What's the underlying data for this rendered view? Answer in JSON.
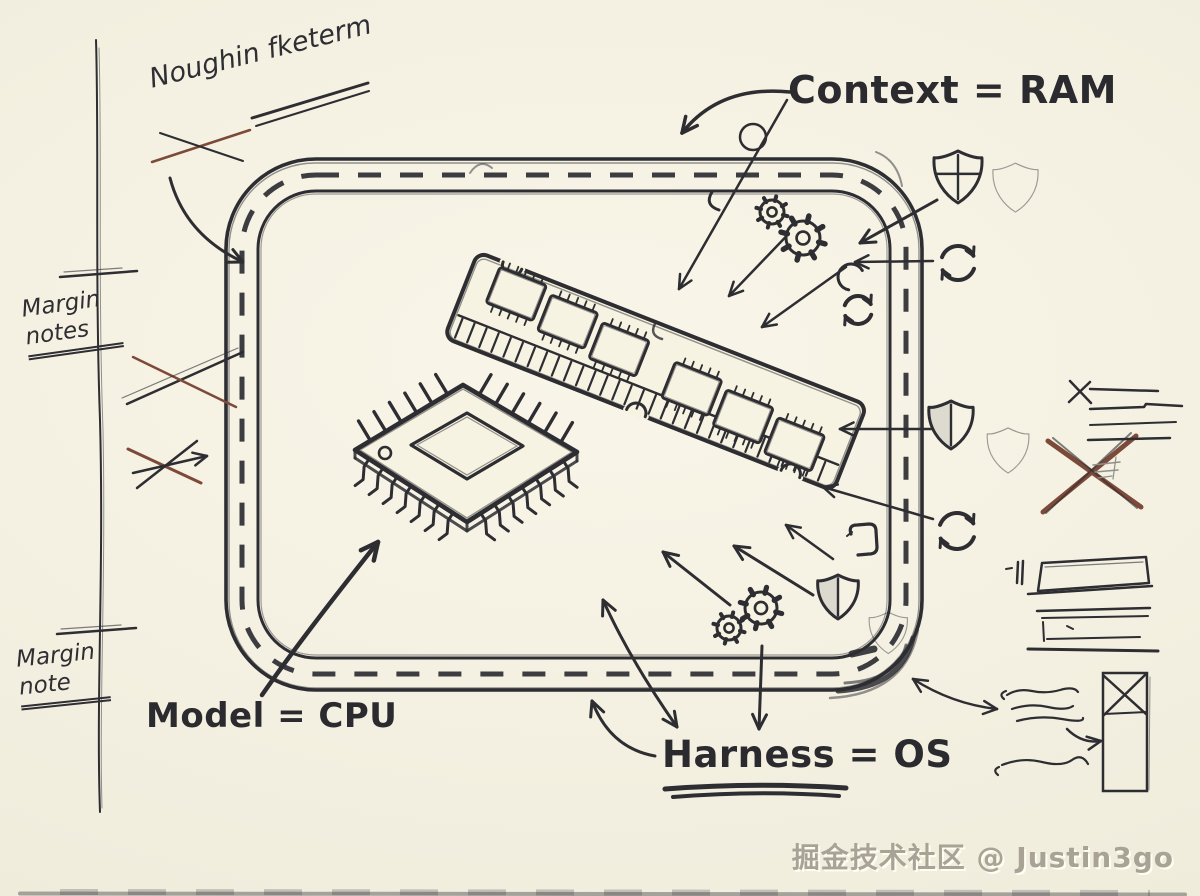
{
  "colors": {
    "paper": "#f7f3e2",
    "ink": "#2d2d32",
    "brown": "#7d4a39",
    "gray": "#90908a",
    "watermark_gray": "#a9a396"
  },
  "sketch": {
    "top_note": "Noughin fketerm",
    "labels": {
      "context": "Context = RAM",
      "model": "Model = CPU",
      "harness": "Harness = OS"
    },
    "margin": {
      "notes": "Margin notes",
      "note": "Margin note"
    },
    "watermark": "掘金技术社区 @ Justin3go",
    "components": [
      "sandbox-boundary",
      "ram-module",
      "cpu-chip"
    ],
    "icons": [
      "shield-cross-icon",
      "shield-icon",
      "gear-icon",
      "refresh-icon",
      "pin-circle-icon",
      "bracket-icon"
    ]
  }
}
